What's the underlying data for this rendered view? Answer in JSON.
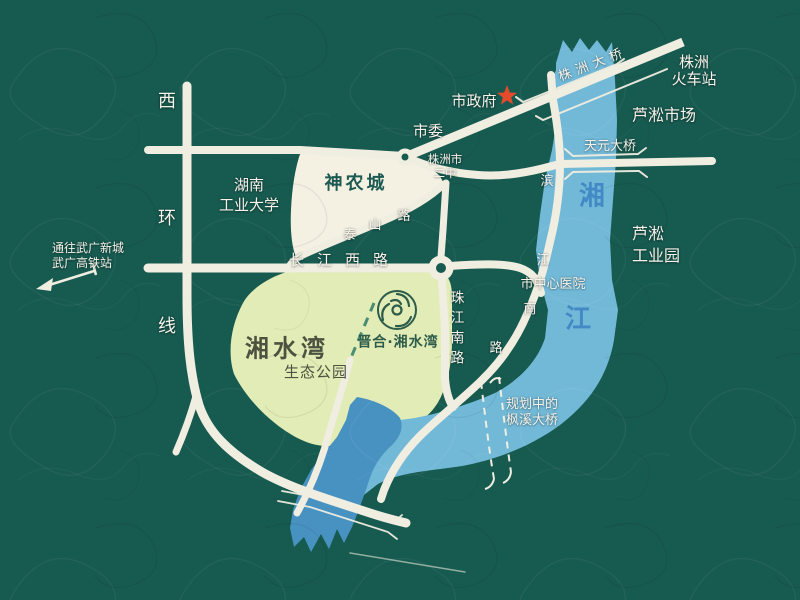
{
  "colors": {
    "bg": "#175a50",
    "road": "#f0ede1",
    "river": "#72b9d8",
    "channel": "#4892c2",
    "park": "#e2ecb6",
    "block": "#f4f1e3",
    "label_dark": "#1d5b52",
    "label_olive": "#4b5340",
    "brand_green": "#2d5c4a",
    "river_text": "#3f86c5",
    "star": "#e34b2a",
    "text_light": "#f5f3ea",
    "dash_green": "#4a8d74"
  },
  "labels": {
    "west_ring_chars": [
      "西",
      "环",
      "线"
    ],
    "hunan_university": "湖南\n工业大学",
    "shennong_city": "神农城",
    "to_wuguang": "通往武广新城\n武广高铁站",
    "changjiang_west_road": "长江西路",
    "taishan_road_chars": [
      "泰",
      "山",
      "路"
    ],
    "city_committee": "市委",
    "city_government": "市政府",
    "no2_middle_school": "株洲市\n二中",
    "zhuzhou_bridge": "株洲大桥",
    "zhuzhou_railway_station": "株洲\n火车站",
    "lusong_market": "芦淞市场",
    "tianyuan_bridge": "天元大桥",
    "river_char_xiang": "湘",
    "river_char_jiang": "江",
    "lusong_industrial_park": "芦淞\n工业园",
    "binjiang_south_road_chars": [
      "滨",
      "江",
      "南",
      "路"
    ],
    "central_hospital": "市中心医院",
    "zhujiang_south_road": "珠江南路",
    "xiangshuiwan": "湘水湾",
    "eco_park": "生态公园",
    "jinhe_xiangshuiwan": "晋合·湘水湾",
    "planned_bridge": "规划中的\n枫溪大桥"
  }
}
